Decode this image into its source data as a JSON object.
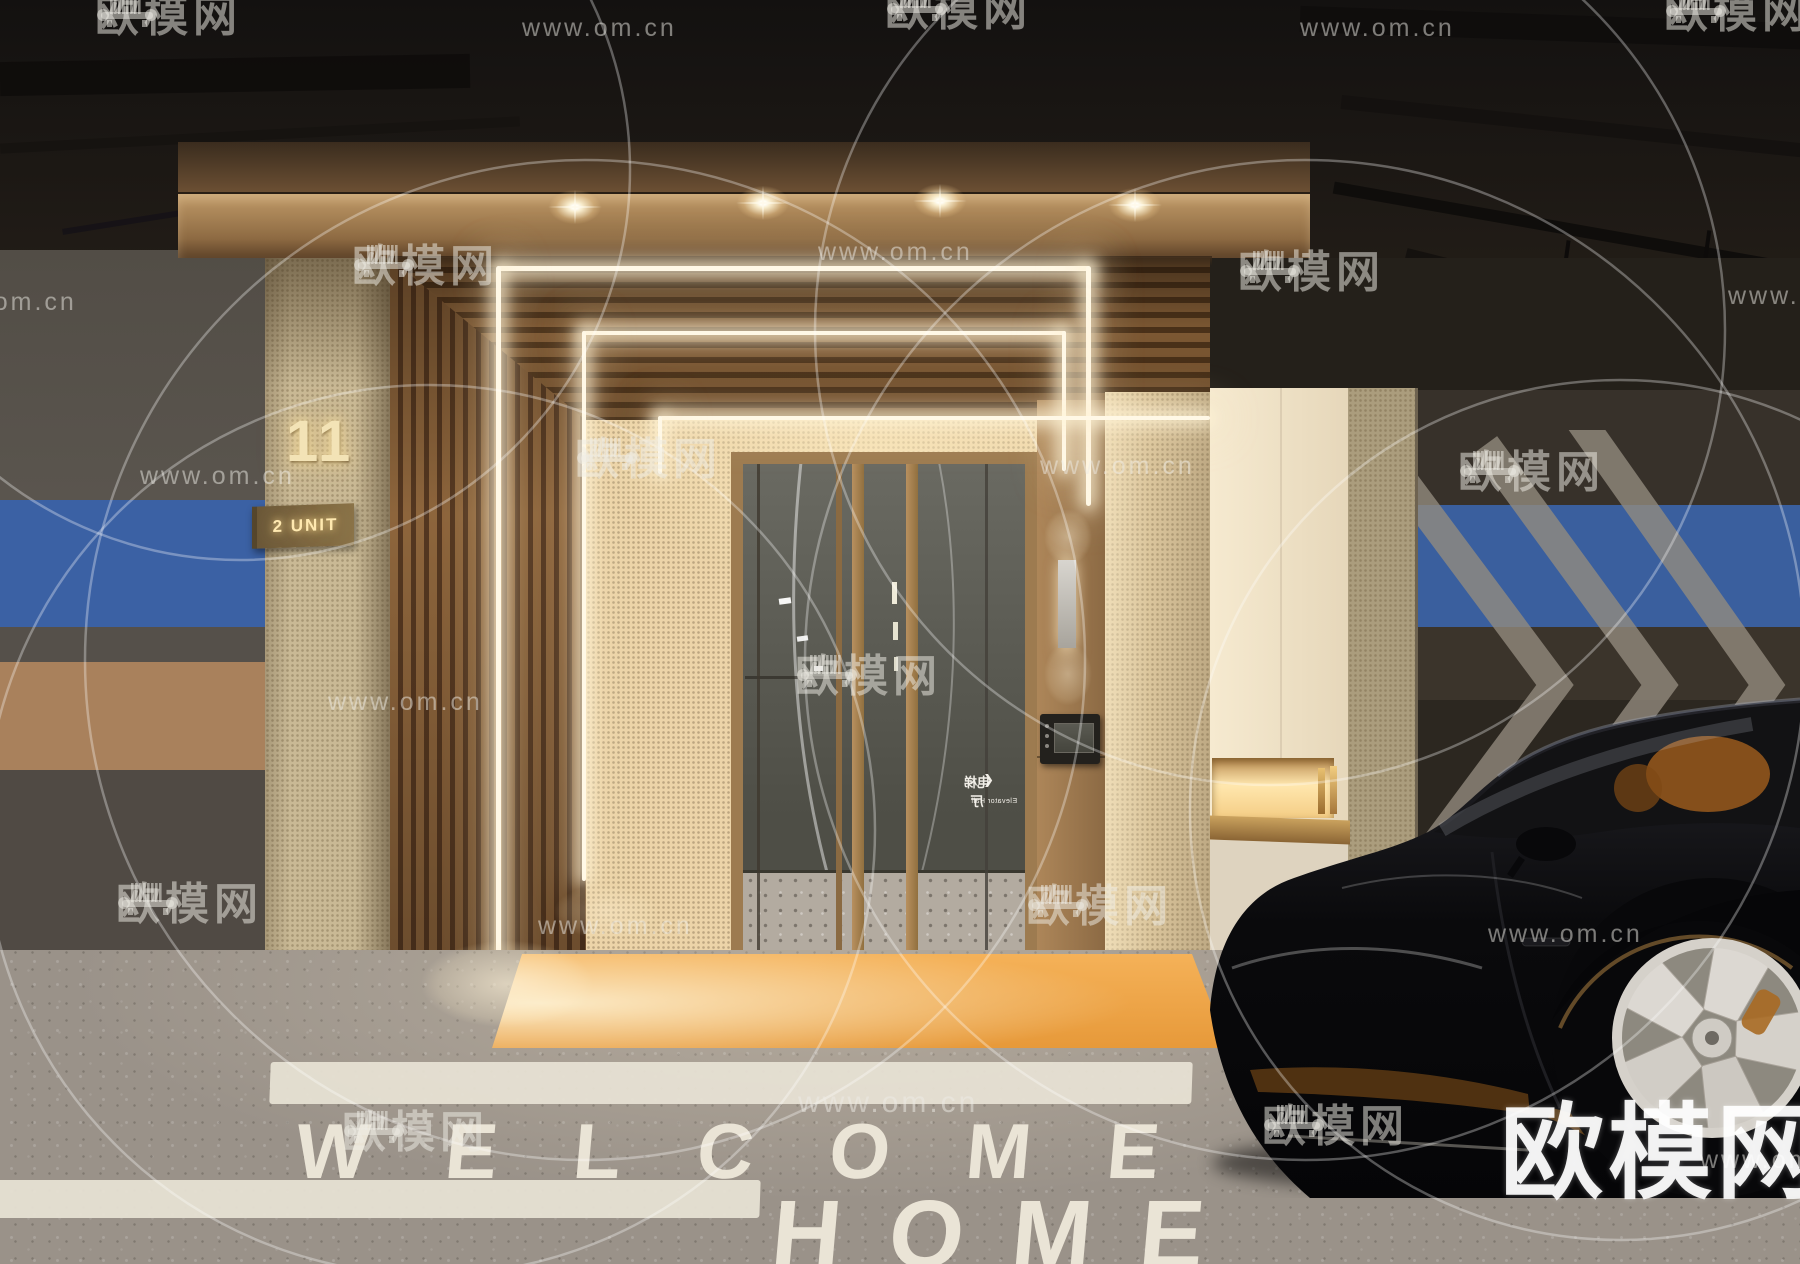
{
  "branding": {
    "site_name": "欧模网",
    "site_url": "www.om.cn",
    "corner_logo": "欧模网"
  },
  "entrance": {
    "building_number": "11",
    "unit_sign": "2 UNIT",
    "door_sign": {
      "arrow": "❮",
      "cn": "电梯厅",
      "en": "Elevator Hall"
    }
  },
  "floor_markings": {
    "line1": "WELCOME",
    "line2": "HOME"
  },
  "colors": {
    "canopy_bronze": "#a57c50",
    "wood_slat": "#8d653c",
    "led_strip": "#fff6e0",
    "entry_mat_orange": "#eda23f",
    "stripe_blue": "#3c64a8",
    "stripe_tan": "#a9815c",
    "wall_cream": "#f2e6cc",
    "terrazzo_gray": "#9a9289",
    "car_black": "#0b0b0d",
    "wheel_silver": "#d8d4cf"
  }
}
